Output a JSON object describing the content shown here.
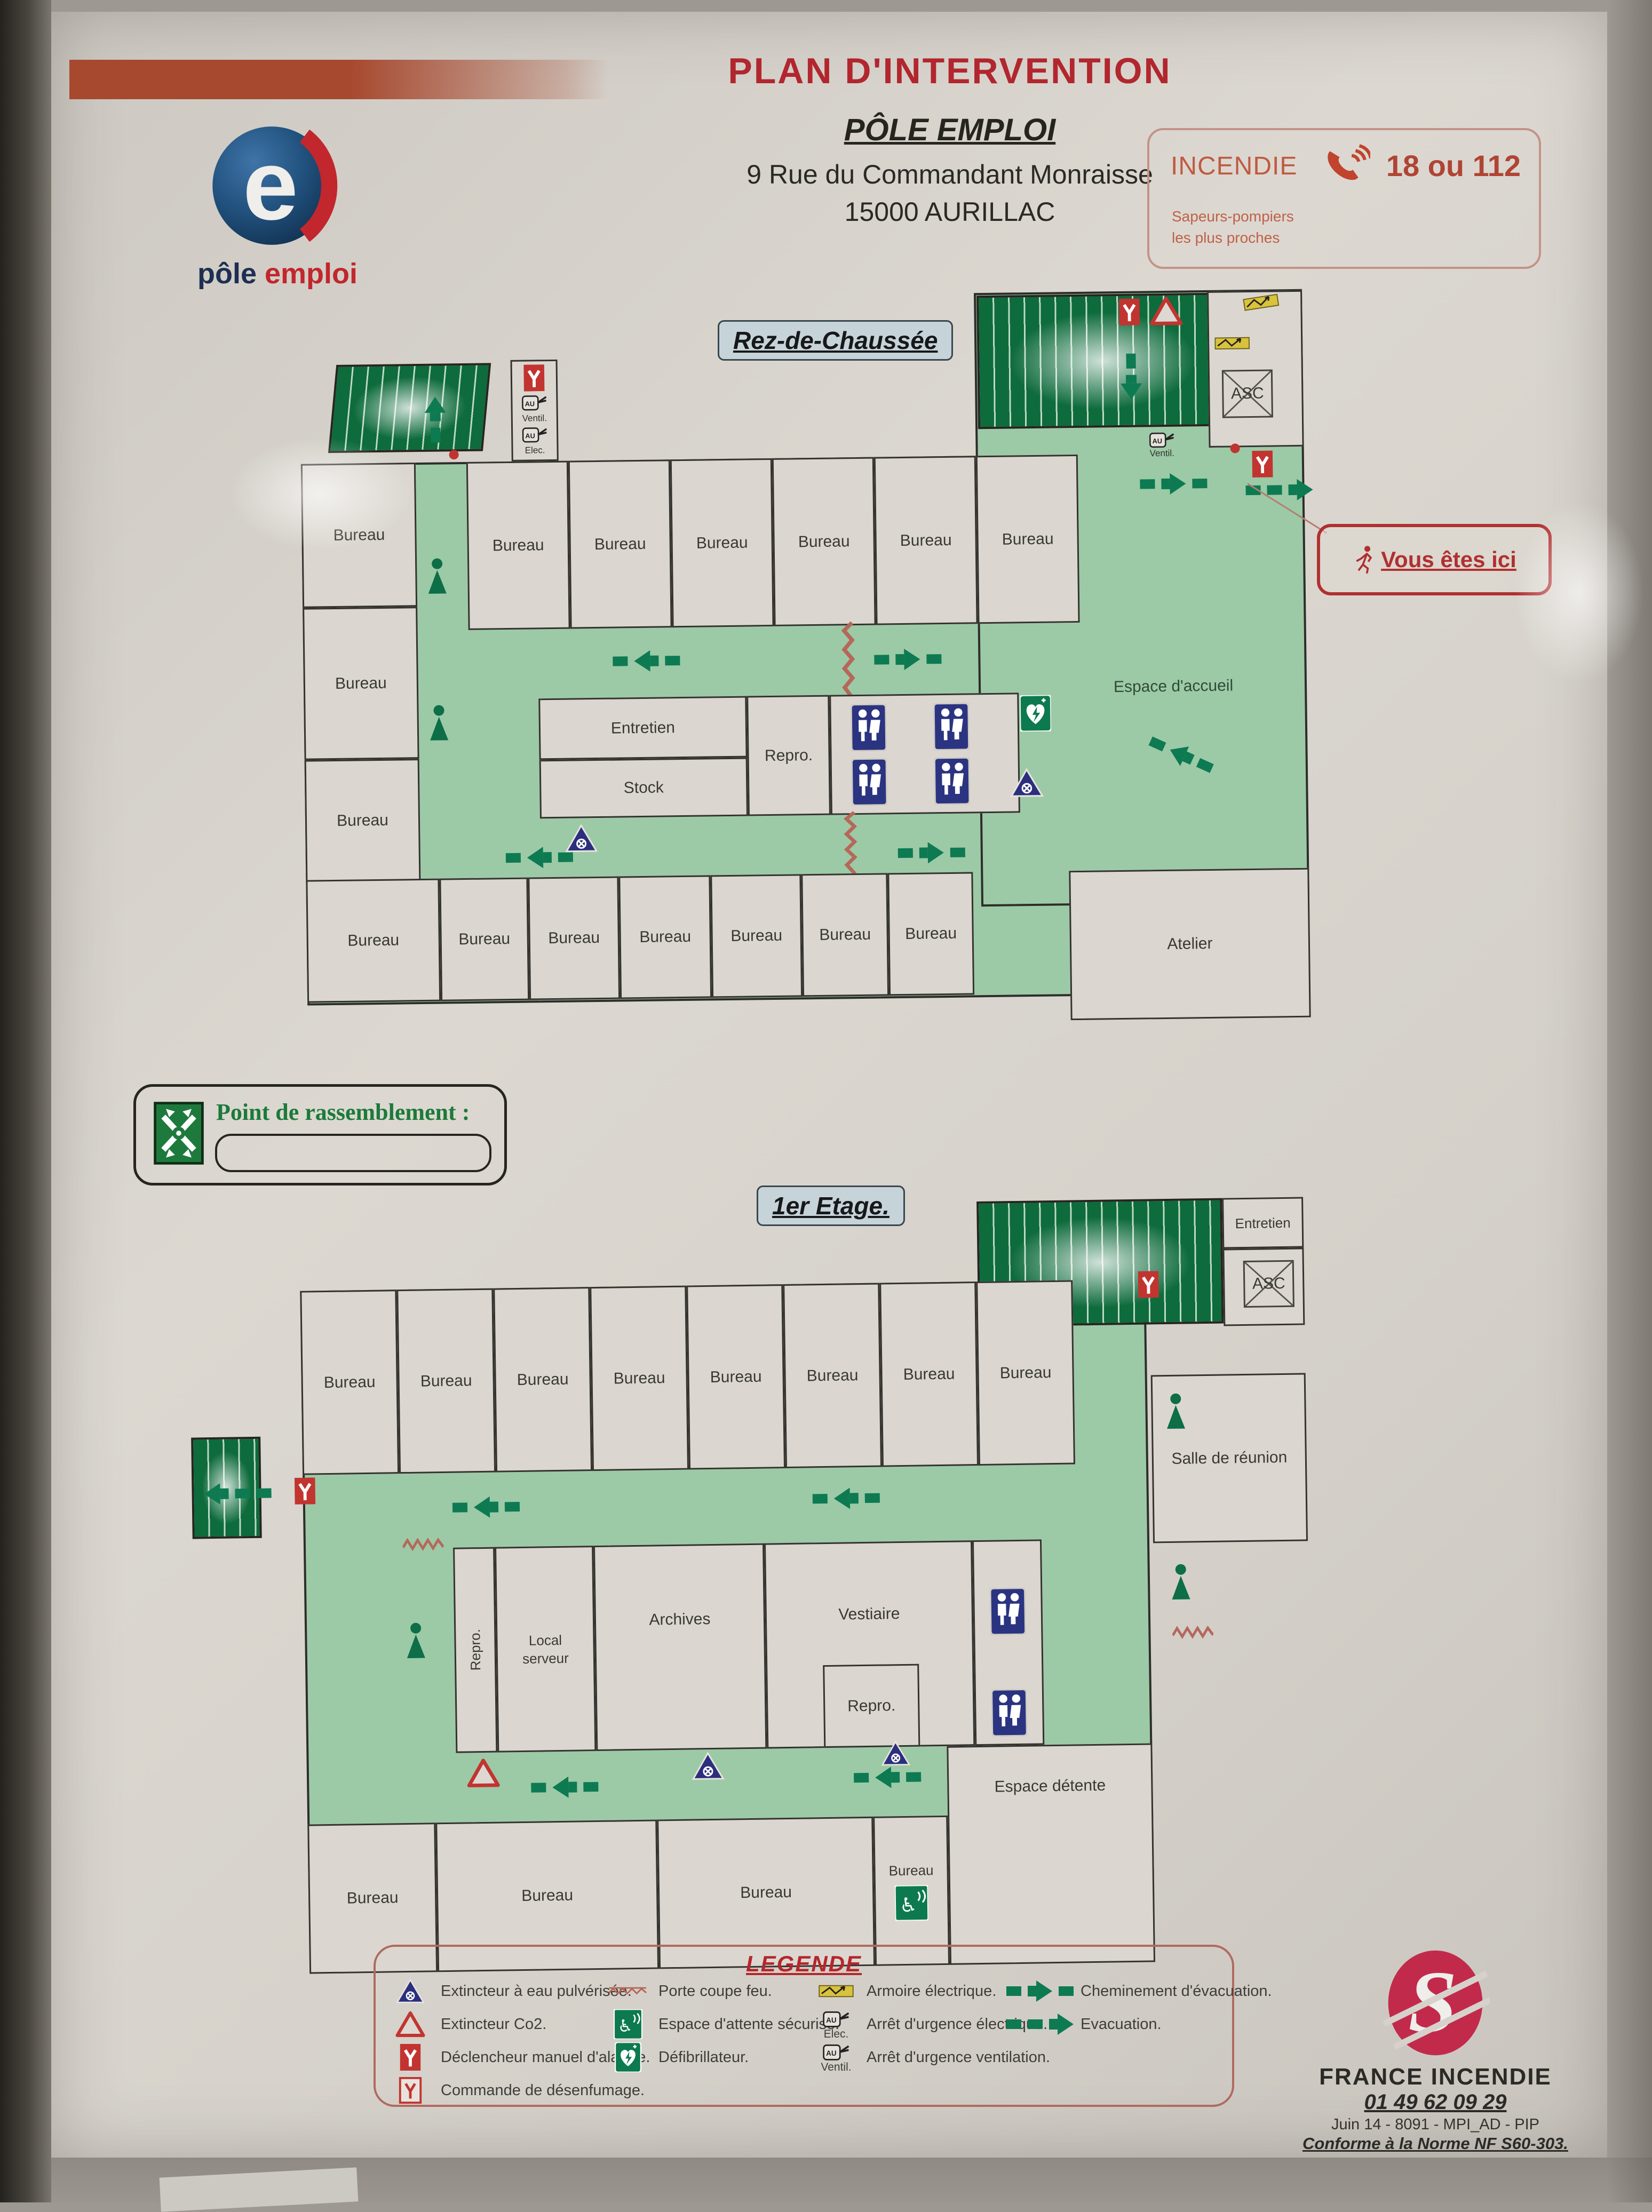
{
  "header": {
    "title": "PLAN D'INTERVENTION",
    "org": "PÔLE EMPLOI",
    "address1": "9 Rue du Commandant Monraisse",
    "address2": "15000 AURILLAC"
  },
  "brand": {
    "word1": "pôle",
    "word2": "emploi"
  },
  "emergency": {
    "label": "INCENDIE",
    "numbers": "18 ou 112",
    "note_line1": "Sapeurs-pompiers",
    "note_line2": "les plus proches"
  },
  "labels": {
    "ventil": "Ventil.",
    "elec": "Elec.",
    "asc": "ASC"
  },
  "ground_floor": {
    "badge": "Rez-de-Chaussée",
    "left_rooms": [
      "Bureau",
      "Bureau",
      "Bureau"
    ],
    "top_rooms": [
      "Bureau",
      "Bureau",
      "Bureau",
      "Bureau",
      "Bureau",
      "Bureau"
    ],
    "bottom_rooms": [
      "Bureau",
      "Bureau",
      "Bureau",
      "Bureau",
      "Bureau",
      "Bureau",
      "Bureau"
    ],
    "mid": {
      "entretien": "Entretien",
      "stock": "Stock",
      "repro": "Repro."
    },
    "accueil": "Espace d'accueil",
    "atelier": "Atelier"
  },
  "you_are_here": {
    "label": "Vous êtes ici"
  },
  "assembly": {
    "label": "Point de rassemblement :"
  },
  "first_floor": {
    "badge": "1er Etage.",
    "top_rooms": [
      "Bureau",
      "Bureau",
      "Bureau",
      "Bureau",
      "Bureau",
      "Bureau",
      "Bureau",
      "Bureau"
    ],
    "bottom_rooms": [
      "Bureau",
      "Bureau",
      "Bureau",
      "Bureau"
    ],
    "rooms": {
      "salle": "Salle de réunion",
      "repro_v": "Repro.",
      "local": "Local serveur",
      "archives": "Archives",
      "vestiaire": "Vestiaire",
      "repro2": "Repro.",
      "detente": "Espace détente",
      "entretien": "Entretien"
    }
  },
  "legend": {
    "title": "LEGENDE",
    "col1": [
      {
        "label": "Extincteur à eau pulvérisée."
      },
      {
        "label": "Extincteur Co2."
      },
      {
        "label": "Déclencheur manuel d'alarme."
      },
      {
        "label": "Commande de désenfumage."
      }
    ],
    "col2": [
      {
        "label": "Porte coupe feu."
      },
      {
        "label": "Espace d'attente sécurisé."
      },
      {
        "label": "Défibrillateur."
      }
    ],
    "col3": [
      {
        "label": "Armoire électrique."
      },
      {
        "label": "Arrêt d'urgence électrique.",
        "caption": "Elec."
      },
      {
        "label": "Arrêt d'urgence ventilation.",
        "caption": "Ventil."
      }
    ],
    "col4": [
      {
        "label": "Cheminement d'évacuation."
      },
      {
        "label": "Evacuation."
      }
    ]
  },
  "footer": {
    "company": "FRANCE INCENDIE",
    "phone": "01 49 62 09 29",
    "reference": "Juin 14 - 8091 - MPI_AD - PIP",
    "norm": "Conforme à la Norme NF S60-303."
  }
}
